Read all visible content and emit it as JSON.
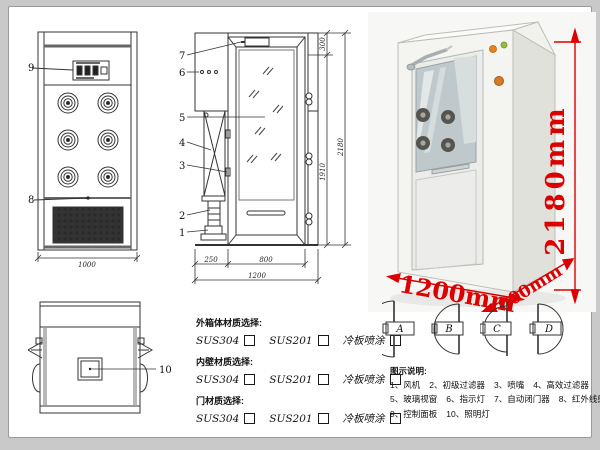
{
  "colors": {
    "dim_red": "#dd0000",
    "line": "#333333"
  },
  "front_view": {
    "callout_control_panel": "9",
    "callout_grille": "8",
    "dim_width": "1000"
  },
  "side_view": {
    "callouts": {
      "c1": "1",
      "c2": "2",
      "c3": "3",
      "c4": "4",
      "c5": "5",
      "c6": "6",
      "c7": "7"
    },
    "dims": {
      "top_section": "300",
      "door_height": "1910",
      "total_height": "2180",
      "bottom_left": "250",
      "bottom_door": "800",
      "bottom_total": "1200"
    }
  },
  "top_view": {
    "callout_lamp": "10"
  },
  "photo": {
    "height": "2180mm",
    "width": "1200mm",
    "depth": "1000mm"
  },
  "door_options": {
    "a": "A",
    "b": "B",
    "c": "C",
    "d": "D"
  },
  "materials": {
    "groups": [
      {
        "title": "外箱体材质选择:",
        "options": [
          "SUS304",
          "SUS201",
          "冷板喷涂"
        ]
      },
      {
        "title": "内壁材质选择:",
        "options": [
          "SUS304",
          "SUS201",
          "冷板喷涂"
        ]
      },
      {
        "title": "门材质选择:",
        "options": [
          "SUS304",
          "SUS201",
          "冷板喷涂"
        ]
      }
    ]
  },
  "legend": {
    "title": "图示说明:",
    "items": [
      "1、风机",
      "2、初级过滤器",
      "3、喷嘴",
      "4、高效过滤器",
      "5、玻璃视窗",
      "6、指示灯",
      "7、自动闭门器",
      "8、红外线感应器",
      "9、控制面板",
      "10、照明灯"
    ]
  }
}
